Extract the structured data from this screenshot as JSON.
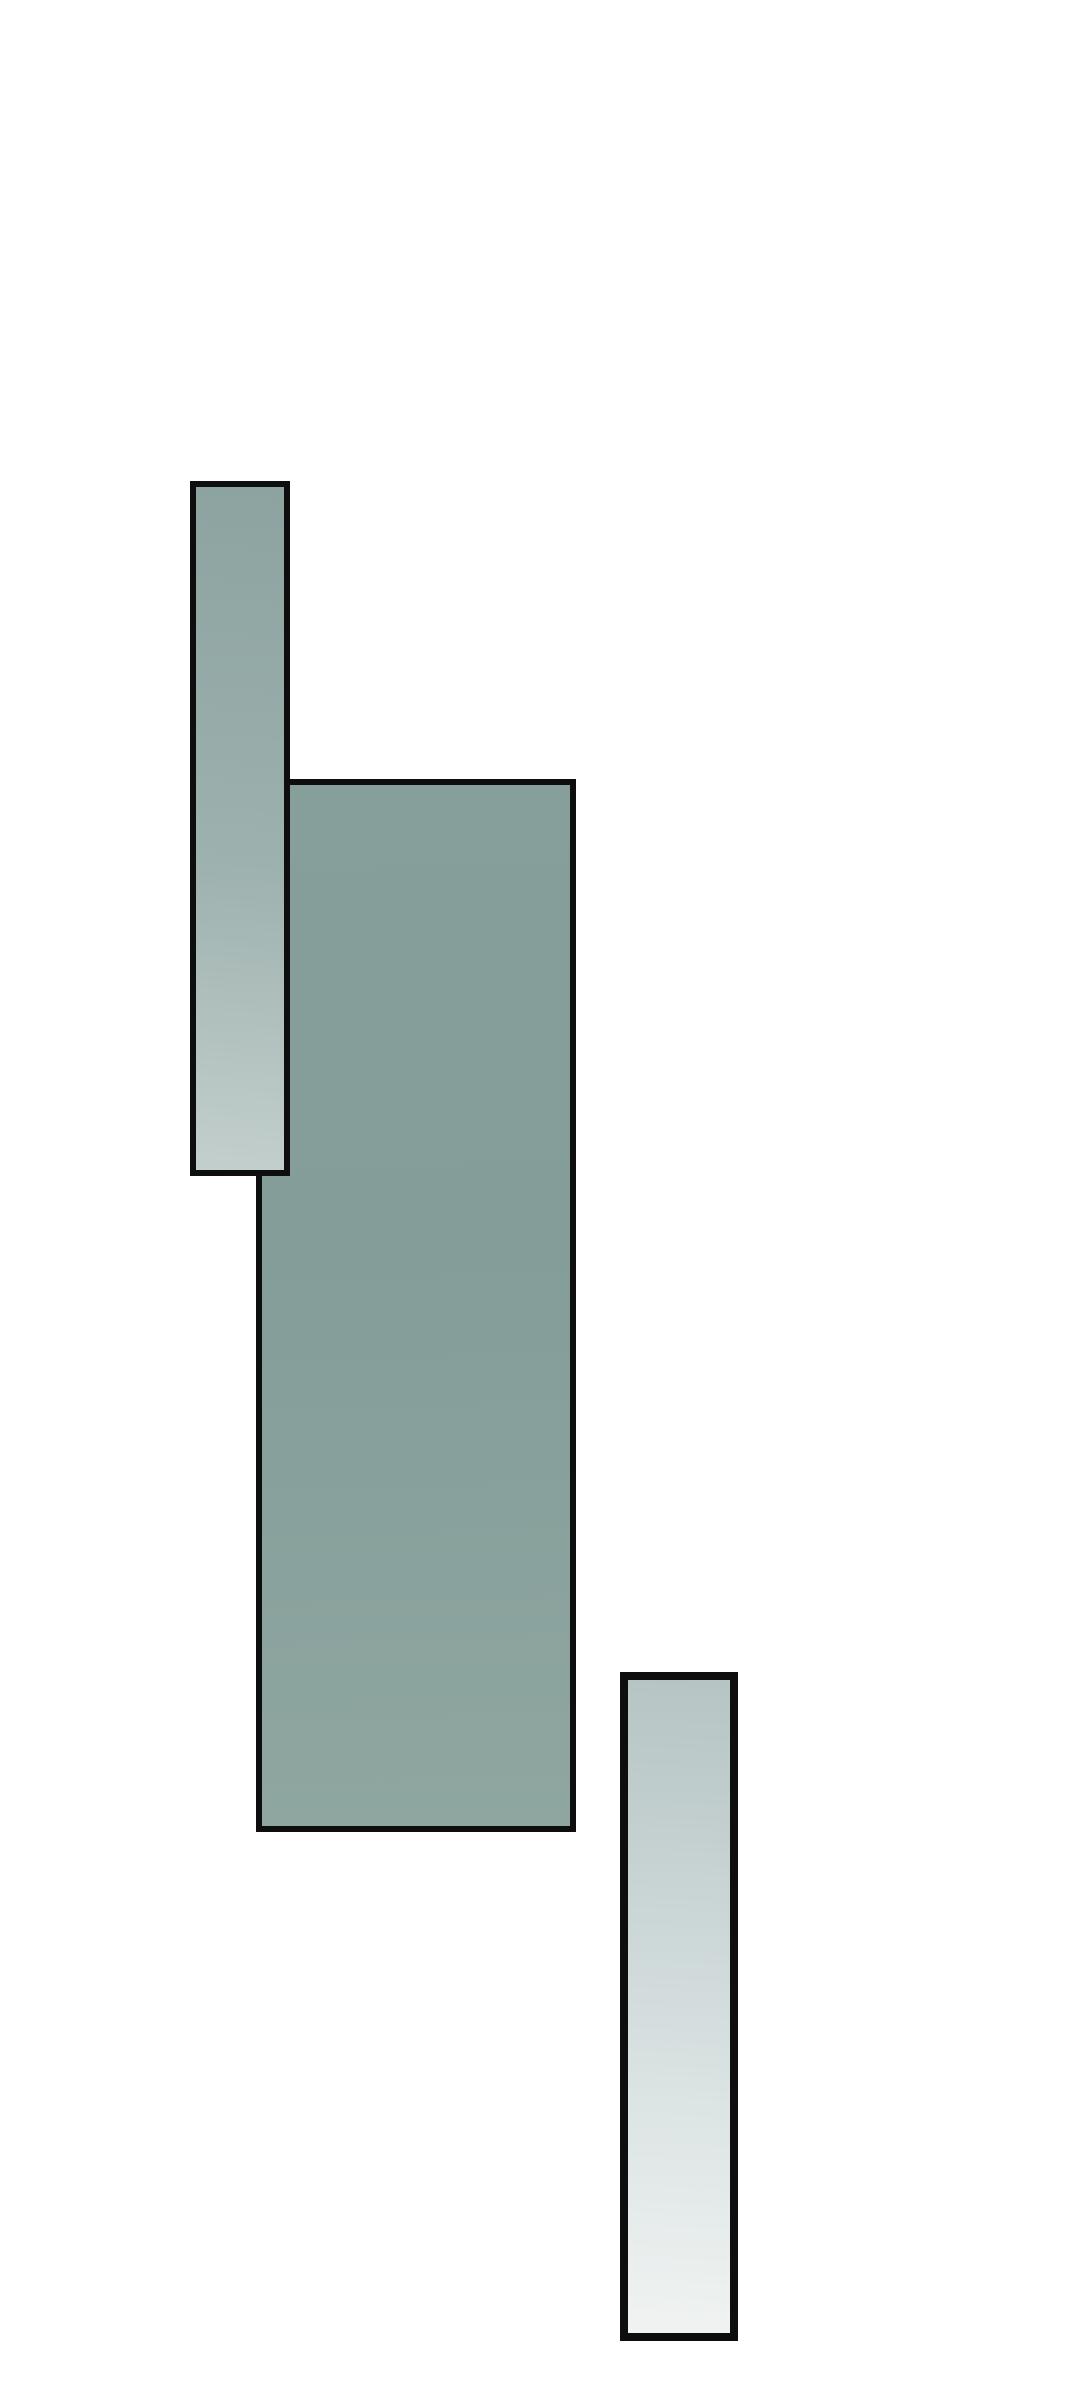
{
  "canvas": {
    "width": 1080,
    "height": 2382,
    "background": "#ffffff"
  },
  "palette": {
    "border_black": "#0e0e0e",
    "panel_teal_gray": "#86a09b",
    "strip_light_top": "#8ca3a0",
    "strip_light_bottom": "#c3cfcd",
    "strip_pale_top": "#b6c4c4",
    "strip_pale_bottom": "#f0f3f2"
  },
  "shapes": [
    {
      "name": "main-panel",
      "x": 256,
      "y": 779,
      "width": 320,
      "height": 1053,
      "z": 1,
      "border_width": 6,
      "border_color": "#0e0e0e",
      "gradient": {
        "angle": 178,
        "stops": [
          {
            "color": "#879f9b",
            "pos": "0%"
          },
          {
            "color": "#849d99",
            "pos": "45%"
          },
          {
            "color": "#8fa6a0",
            "pos": "100%"
          }
        ]
      }
    },
    {
      "name": "left-strip-panel",
      "x": 190,
      "y": 481,
      "width": 100,
      "height": 695,
      "z": 2,
      "border_width": 6,
      "border_color": "#0e0e0e",
      "gradient": {
        "angle": 185,
        "stops": [
          {
            "color": "#8ca3a0",
            "pos": "0%"
          },
          {
            "color": "#9db1ae",
            "pos": "55%"
          },
          {
            "color": "#c3cfcd",
            "pos": "100%"
          }
        ]
      }
    },
    {
      "name": "right-strip-panel",
      "x": 620,
      "y": 1672,
      "width": 118,
      "height": 669,
      "z": 1,
      "border_width": 8,
      "border_color": "#0e0e0e",
      "gradient": {
        "angle": 183,
        "stops": [
          {
            "color": "#b6c4c4",
            "pos": "0%"
          },
          {
            "color": "#dce4e4",
            "pos": "65%"
          },
          {
            "color": "#f0f3f2",
            "pos": "100%"
          }
        ]
      }
    }
  ]
}
